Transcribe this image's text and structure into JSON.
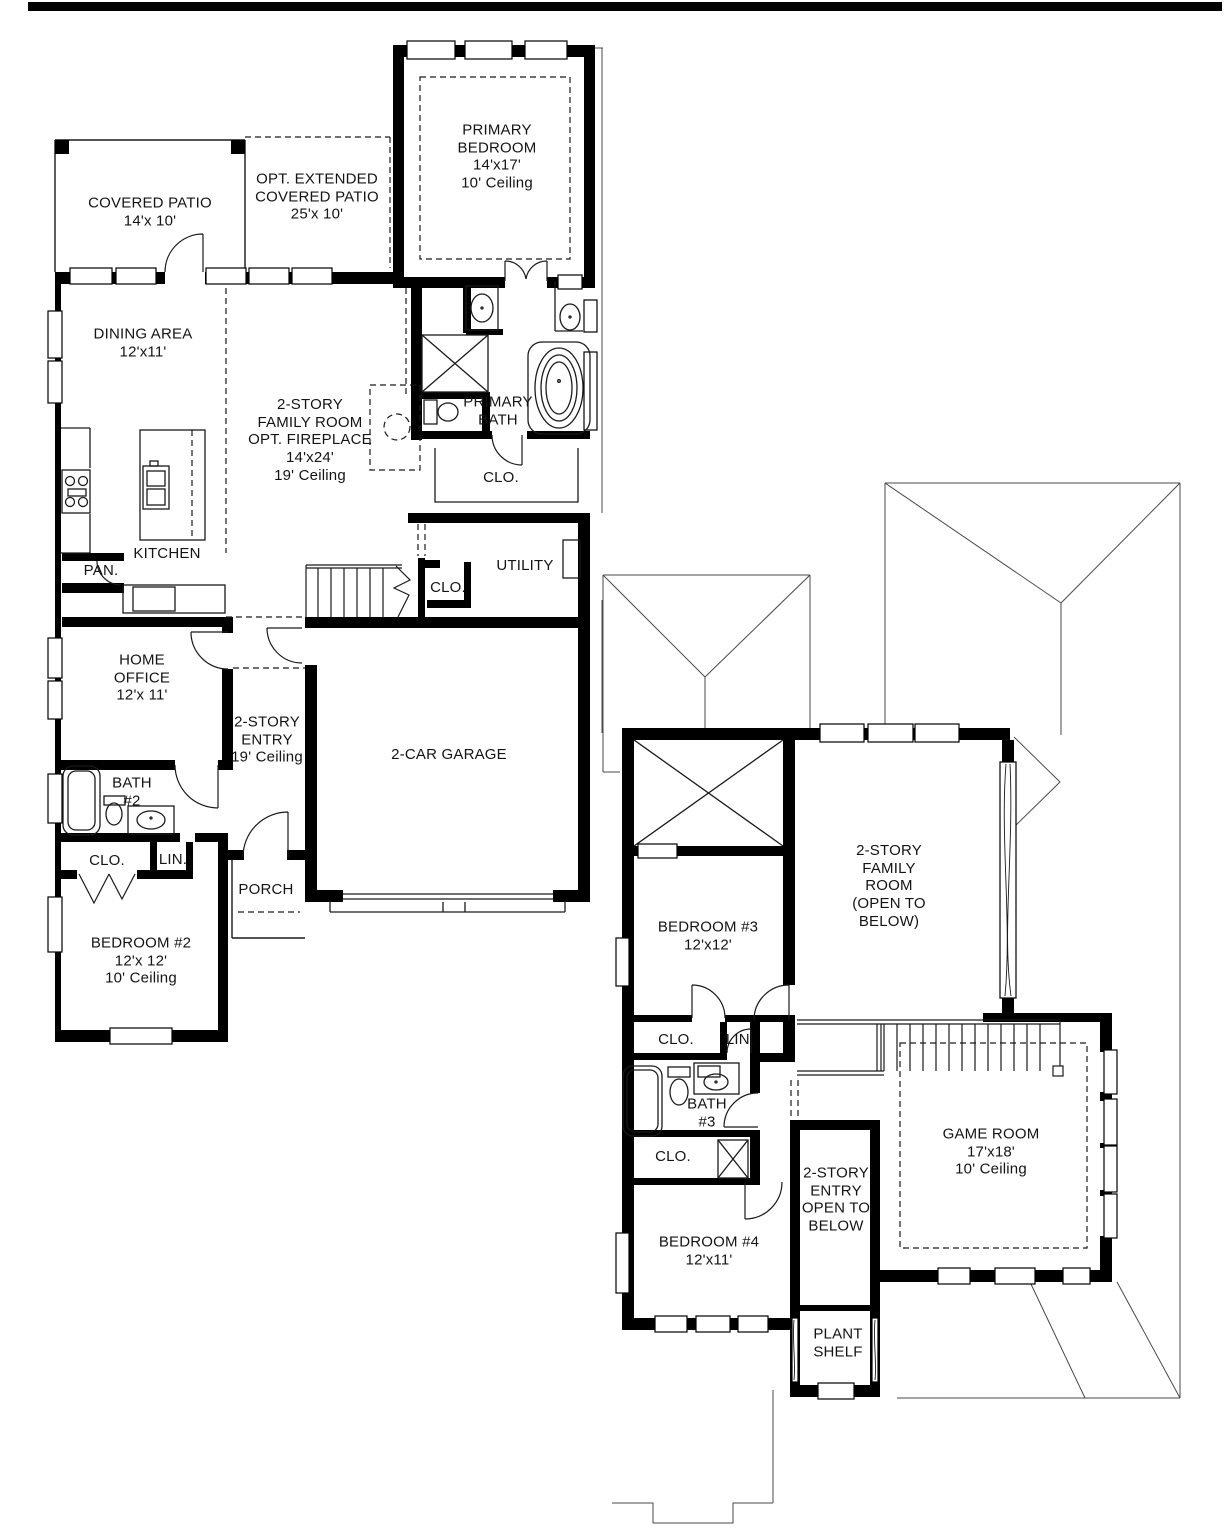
{
  "page": {
    "background": "#ffffff",
    "top_bar_color": "#000000",
    "wall_color": "#000000",
    "line_color": "#1a1a1a",
    "roof_line_color": "#4a4a4a"
  },
  "fp": {
    "f1": {
      "covered_patio": "COVERED PATIO\n14'x 10'",
      "ext_patio": "OPT. EXTENDED\nCOVERED PATIO\n25'x 10'",
      "primary_bedroom": "PRIMARY\nBEDROOM\n14'x17'\n10' Ceiling",
      "dining": "DINING AREA\n12'x11'",
      "family_room": "2-STORY\nFAMILY ROOM\nOPT. FIREPLACE\n14'x24'\n19' Ceiling",
      "primary_bath": "PRIMARY\nBATH",
      "primary_closet": "CLO.",
      "kitchen": "KITCHEN",
      "pantry": "PAN.",
      "utility": "UTILITY",
      "stair_closet": "CLO.",
      "home_office": "HOME\nOFFICE\n12'x 11'",
      "entry": "2-STORY\nENTRY\n19' Ceiling",
      "garage": "2-CAR GARAGE",
      "bath2": "BATH\n#2",
      "closet2": "CLO.",
      "linen": "LIN.",
      "porch": "PORCH",
      "bedroom2": "BEDROOM #2\n12'x 12'\n10' Ceiling"
    },
    "f2": {
      "bedroom3": "BEDROOM #3\n12'x12'",
      "family_room_open": "2-STORY\nFAMILY\nROOM\n(OPEN TO\nBELOW)",
      "closet3": "CLO.",
      "linen2": "LIN.",
      "bath3": "BATH\n#3",
      "closet4": "CLO.",
      "bedroom4": "BEDROOM #4\n12'x11'",
      "entry_open": "2-STORY\nENTRY\nOPEN TO\nBELOW",
      "plant_shelf": "PLANT\nSHELF",
      "game_room": "GAME ROOM\n17'x18'\n10' Ceiling"
    }
  }
}
